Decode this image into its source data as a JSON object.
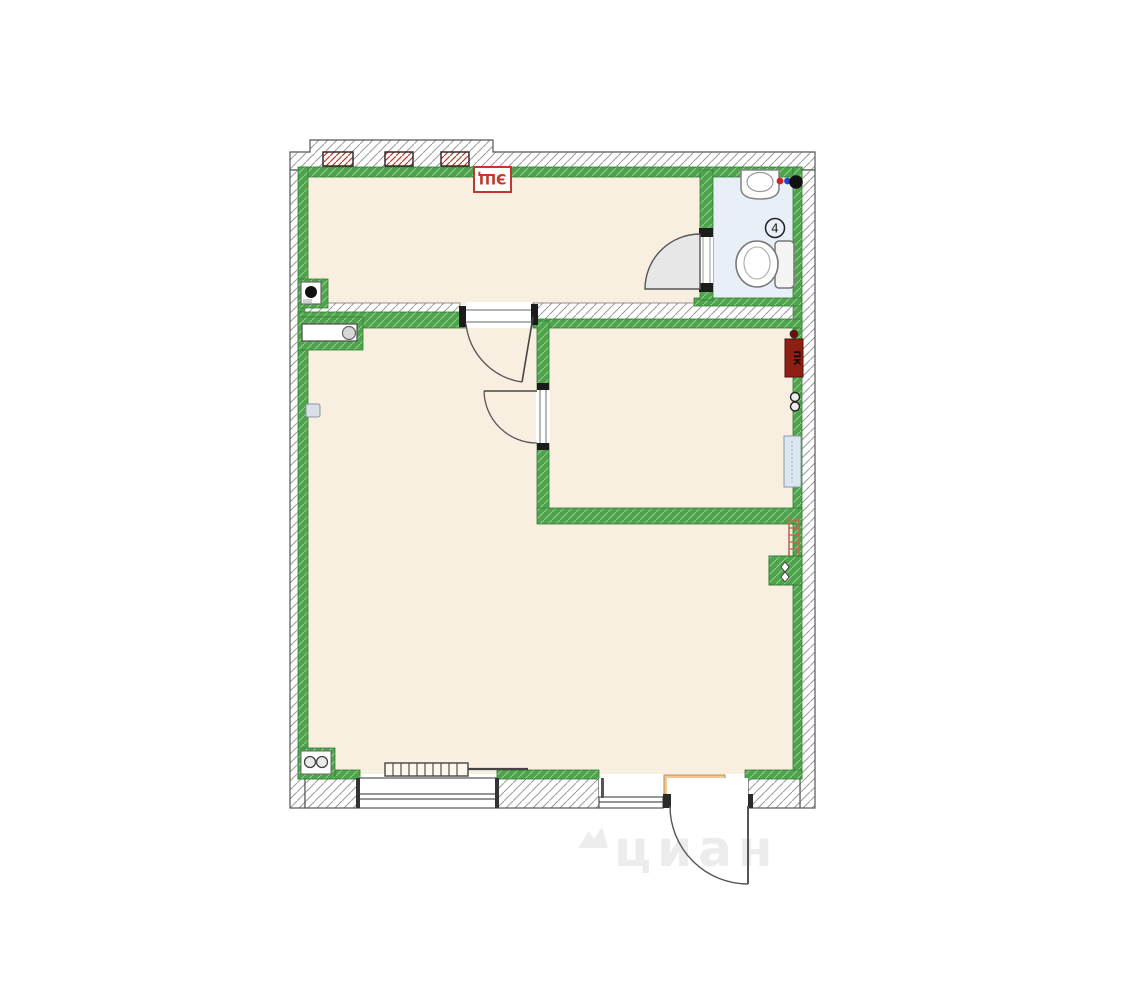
{
  "floor_plan": {
    "kind": "apartment-floor-plan",
    "watermark": "циан",
    "labels": {
      "electrical_panel": "ЭЩ",
      "fire_hose_cabinet": "ПК",
      "bathroom_number": "4",
      "entrance_heat_curtain": "тепловая завеса"
    },
    "colors": {
      "room_floor": "#f9efe0",
      "bathroom_floor": "#e9eff6",
      "wall_green": "#4fa34d",
      "outer_wall_hatch_line": "#999999",
      "label_red": "#c0392b",
      "fire_cabinet_red": "#8e1f14",
      "heat_curtain_tan": "#f2c993",
      "radiator_blue": "#dce6f0",
      "ladder_red": "#c06a4e",
      "watermark_gray": "#ececec"
    },
    "fixtures": [
      "vent-grille",
      "riser",
      "sink",
      "hot-cold-valves",
      "toilet",
      "counter-column",
      "fire-ladder",
      "duct-box",
      "radiator",
      "baseboard-radiator",
      "pipes",
      "window",
      "entrance-door"
    ]
  }
}
